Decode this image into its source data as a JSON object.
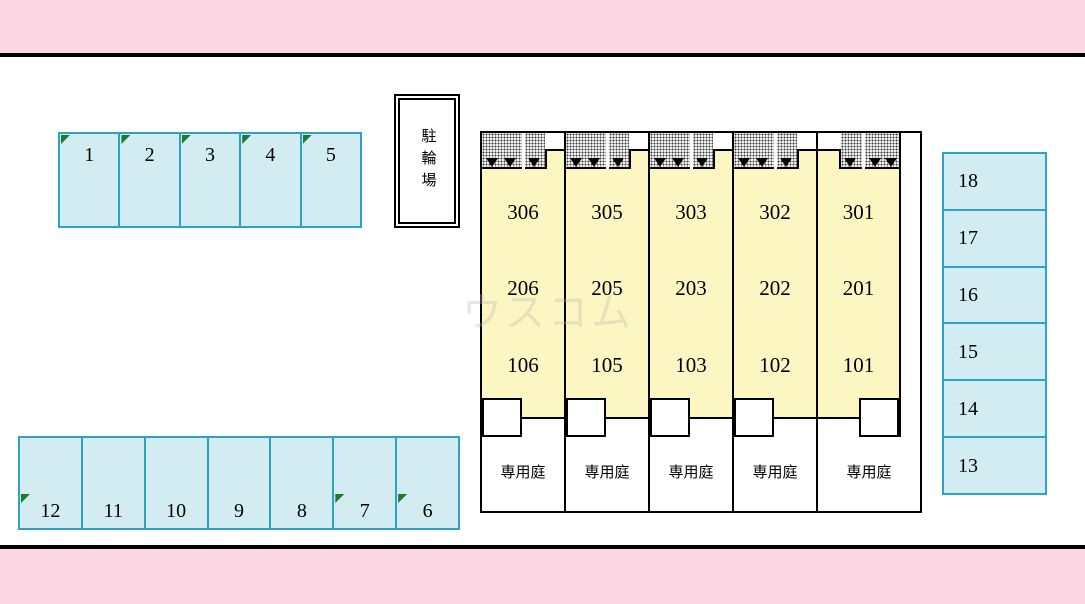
{
  "plan": {
    "bike_parking_label": "駐輪場",
    "garden_label": "専用庭",
    "watermark": "ウスコム"
  },
  "colors": {
    "band_pink": "#fdd8e4",
    "line_black": "#000000",
    "parking_fill": "#d2ecf2",
    "parking_border": "#2ba3c8",
    "unit_fill": "#fcf6c2",
    "marker_green": "#1e7b2e"
  },
  "parking": {
    "top_row": {
      "spaces": [
        {
          "label": "1",
          "marker": true
        },
        {
          "label": "2",
          "marker": true
        },
        {
          "label": "3",
          "marker": true
        },
        {
          "label": "4",
          "marker": true
        },
        {
          "label": "5",
          "marker": true
        }
      ]
    },
    "bottom_row": {
      "spaces": [
        {
          "label": "12",
          "marker": true
        },
        {
          "label": "11",
          "marker": false
        },
        {
          "label": "10",
          "marker": false
        },
        {
          "label": "9",
          "marker": false
        },
        {
          "label": "8",
          "marker": false
        },
        {
          "label": "7",
          "marker": true
        },
        {
          "label": "6",
          "marker": true
        }
      ]
    },
    "right_column": {
      "spaces": [
        {
          "label": "18"
        },
        {
          "label": "17"
        },
        {
          "label": "16"
        },
        {
          "label": "15"
        },
        {
          "label": "14"
        },
        {
          "label": "13"
        }
      ]
    }
  },
  "building": {
    "columns": [
      {
        "units": [
          "306",
          "206",
          "106"
        ]
      },
      {
        "units": [
          "305",
          "205",
          "105"
        ]
      },
      {
        "units": [
          "303",
          "203",
          "103"
        ]
      },
      {
        "units": [
          "302",
          "202",
          "102"
        ]
      },
      {
        "units": [
          "301",
          "201",
          "101"
        ]
      }
    ]
  }
}
